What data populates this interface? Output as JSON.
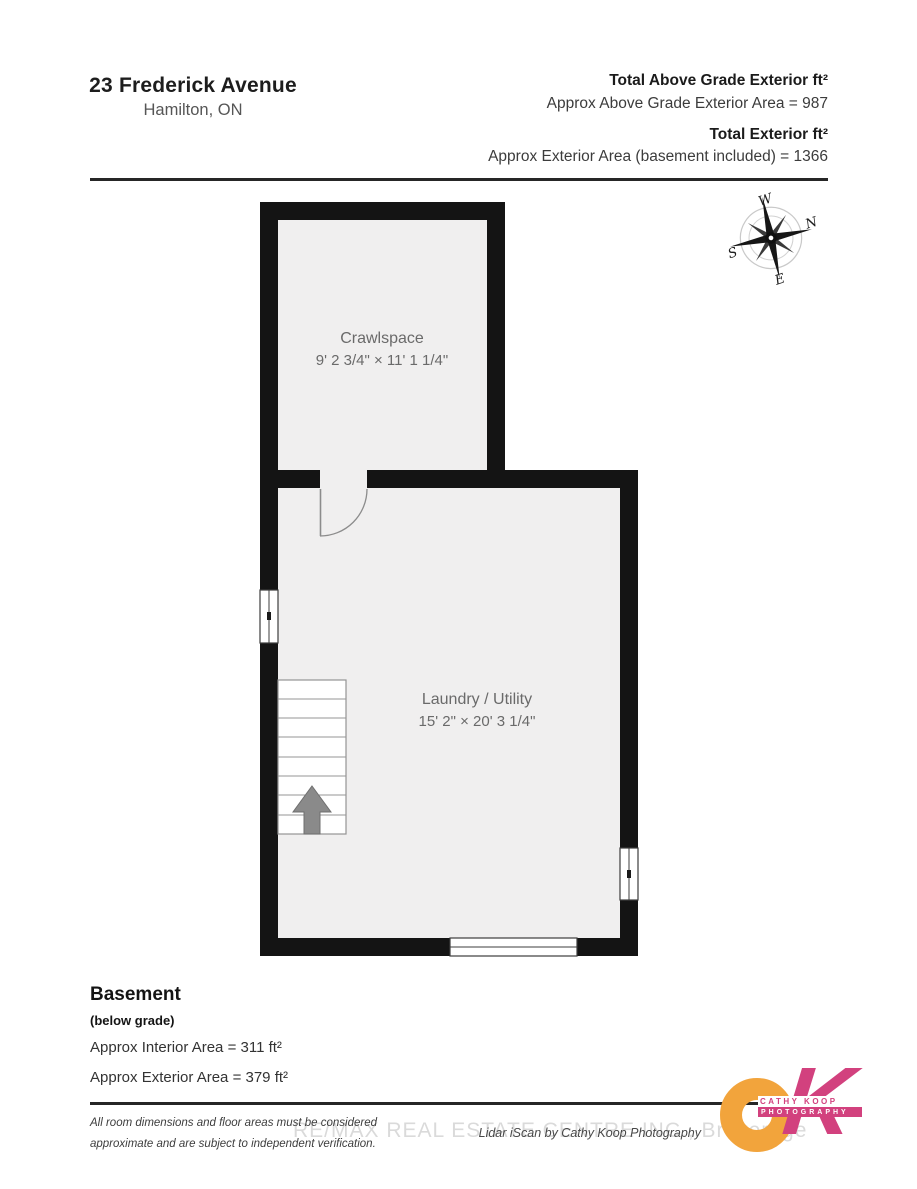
{
  "header": {
    "address_line1": "23 Frederick Avenue",
    "address_line2": "Hamilton, ON",
    "totals": [
      {
        "label": "Total Above Grade Exterior ft²",
        "value": "Approx Above Grade Exterior Area = 987"
      },
      {
        "label": "Total Exterior ft²",
        "value": "Approx Exterior Area (basement included) = 1366"
      }
    ]
  },
  "compass": {
    "n": "N",
    "e": "E",
    "s": "S",
    "w": "W",
    "rotation_deg": 78
  },
  "floorplan": {
    "rooms": [
      {
        "name": "Crawlspace",
        "dimensions": "9' 2 3/4\" × 11' 1 1/4\""
      },
      {
        "name": "Laundry / Utility",
        "dimensions": "15' 2\" × 20' 3 1/4\""
      }
    ],
    "features": [
      "stairs-up",
      "door-swing",
      "window-left",
      "window-right",
      "window-bottom"
    ],
    "colors": {
      "wall": "#141414",
      "floor": "#f0efef",
      "stair_arrow": "#8a8a8a"
    }
  },
  "summary": {
    "title": "Basement",
    "subtitle": "(below grade)",
    "interior_area": "Approx Interior Area = 311 ft²",
    "exterior_area": "Approx Exterior Area = 379 ft²"
  },
  "footer": {
    "disclaimer_line1": "All room dimensions and floor areas must be considered",
    "disclaimer_line2": "approximate and are subject to independent verification.",
    "watermark": "RE/MAX REAL ESTATE CENTRE INC., Brokerage",
    "credit": "Lidar iScan by Cathy Koop Photography",
    "logo": {
      "o": "O",
      "k": "K",
      "name_line1": "CATHY KOOP",
      "name_line2": "PHOTOGRAPHY",
      "orange": "#F2A43C",
      "pink": "#D2417E"
    }
  }
}
